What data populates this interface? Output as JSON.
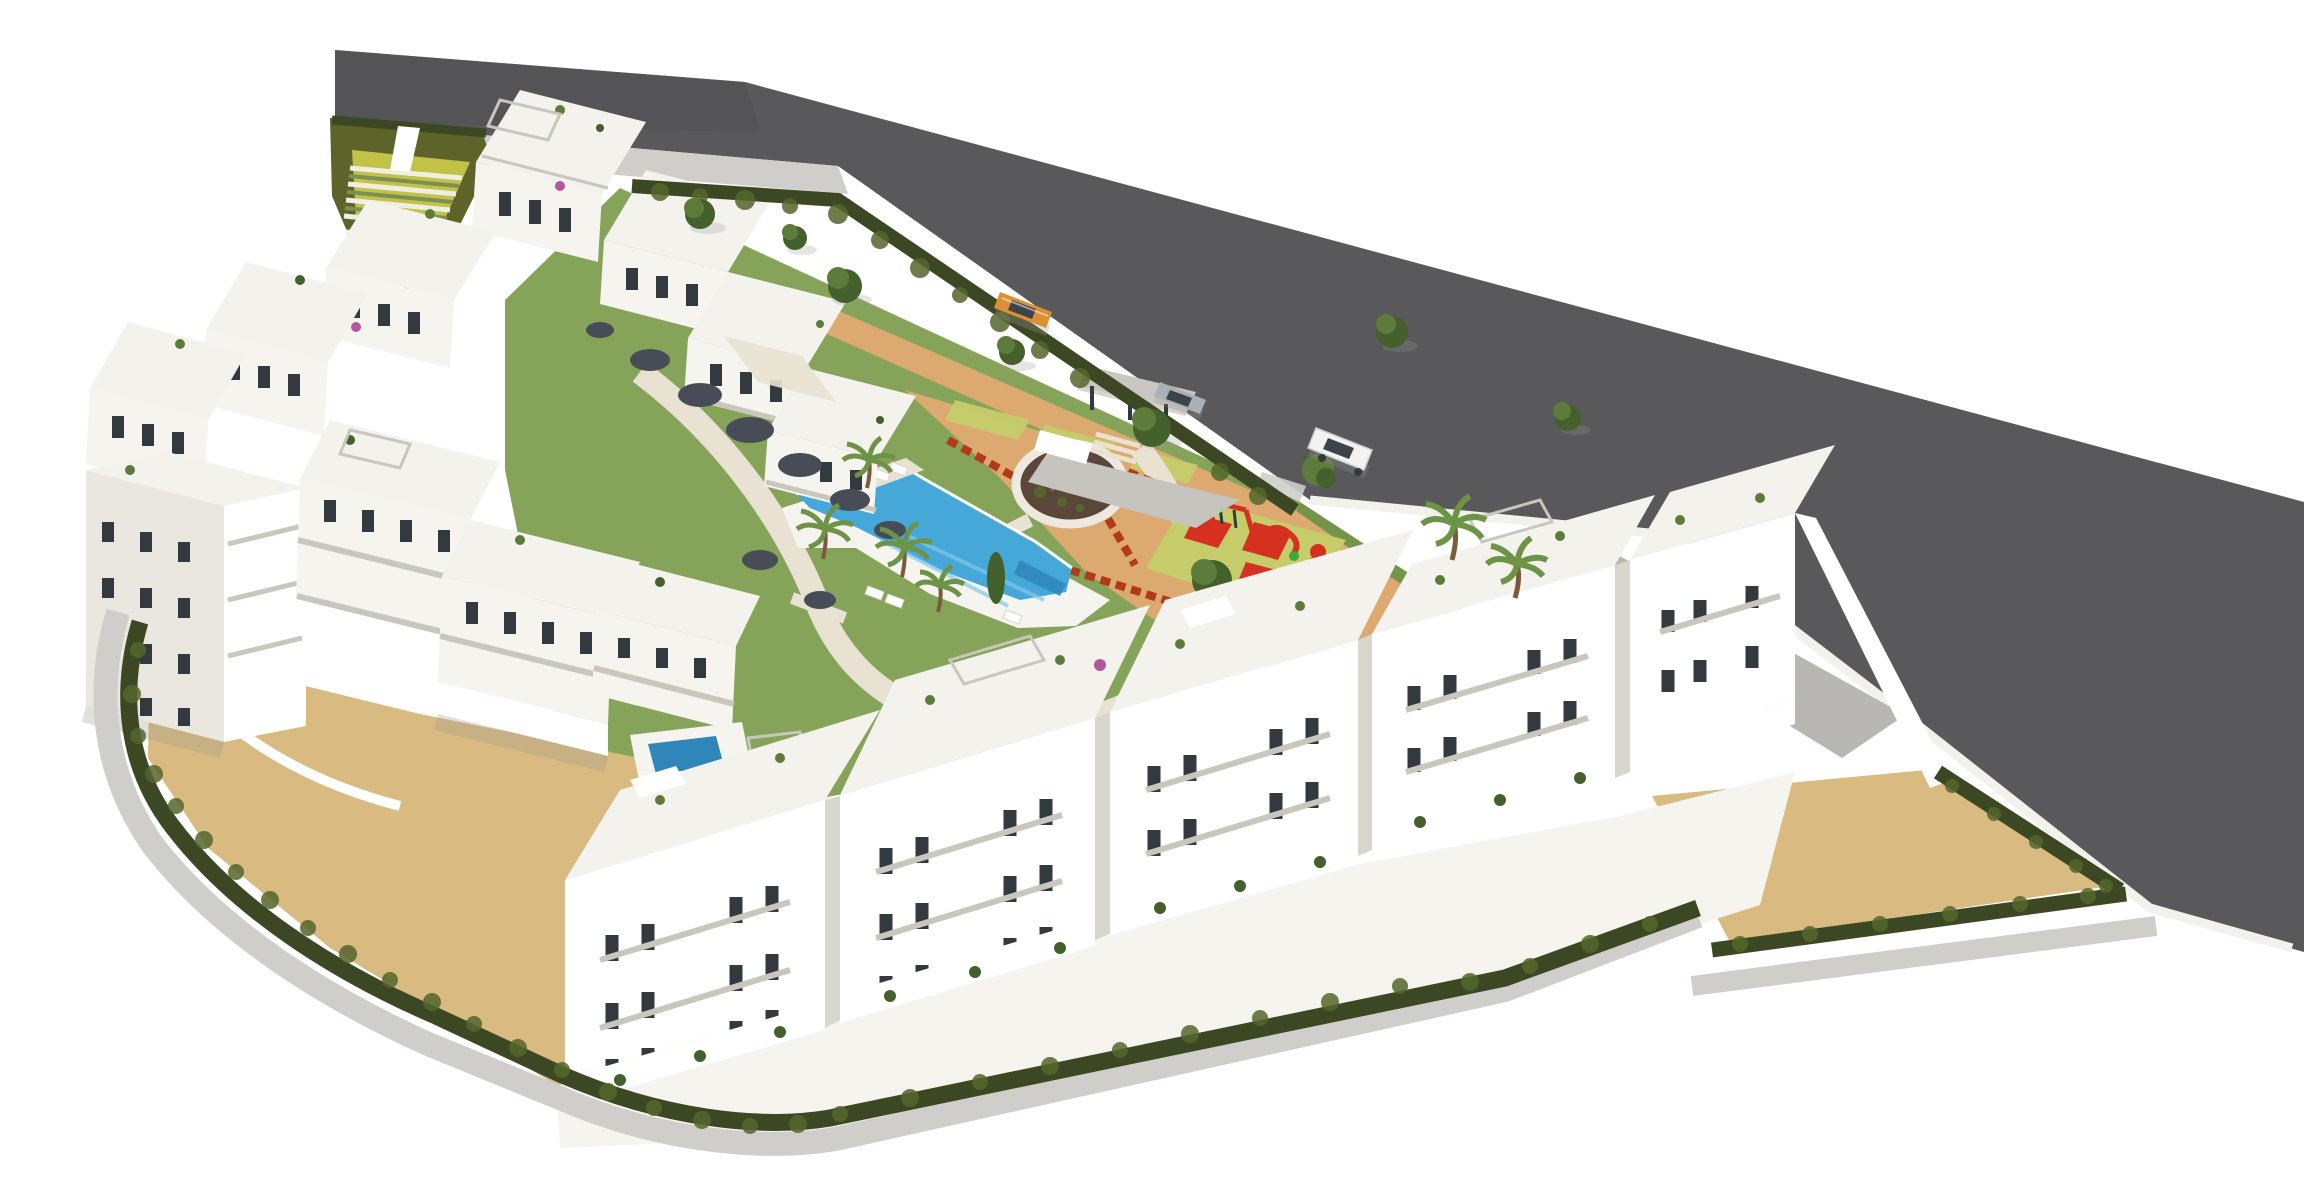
{
  "scene": {
    "type": "aerial-architectural-render",
    "subject": "white residential apartment complex with communal gardens",
    "features": [
      "perimeter-road",
      "amphitheatre-garden-steps",
      "terraced-apartment-cluster",
      "front-apartment-row",
      "communal-swimming-pool",
      "kids-pool",
      "sun-loungers",
      "circular-plaza-with-monument",
      "children-playground",
      "entrance-canopy",
      "perimeter-hedge",
      "sand-courtyards",
      "palm-trees",
      "street-trees"
    ],
    "vehicles": [
      {
        "name": "orange-car",
        "color": "#dd8f35"
      },
      {
        "name": "silver-car",
        "color": "#a9b0b6"
      },
      {
        "name": "white-suv",
        "color": "#f3f3f2"
      }
    ]
  },
  "colors": {
    "white": "#ffffff",
    "road": "#59585b",
    "roadEnd": "#4d4d50",
    "sidewalk": "#cfcecb",
    "curb": "#f2f1ec",
    "apron": "#b9b7b3",
    "hedge": "#3b4823",
    "hedge2": "#55662c",
    "olive": "#5e6429",
    "terraceYellow": "#c2c148",
    "stepWhite": "#efeee2",
    "stepGreen": "#7d9053",
    "lawn": "#85a45a",
    "lawn2": "#749549",
    "shrub": "#474c57",
    "sand": "#d9ba80",
    "terracotta": "#dcaa70",
    "path": "#e9e2d2",
    "paving": "#c6c4bf",
    "matYellow": "#c6cc6a",
    "playRed": "#d63020",
    "playGreen": "#3fa83b",
    "pool": "#45a8d9",
    "pool2": "#83c8ea",
    "pool3": "#2f86bb",
    "flower": "#b23a1a",
    "face": "#f6f4ef",
    "faceShade": "#e9e7df",
    "faceDeep": "#d9d6cd",
    "roof": "#f3f2ec",
    "window": "#333a3f",
    "frame": "#c9c6bd",
    "tree": "#5d7c3c",
    "treeDark": "#44602c",
    "palm": "#6d9346",
    "trunk": "#7a5b3a",
    "magenta": "#b5569a",
    "carOrange": "#dd8f35",
    "carSilver": "#a9b0b6",
    "carWhite": "#f3f3f2",
    "glass": "#3c4349",
    "canopy": "#c9c7c2",
    "mulch": "#5a4739",
    "stone": "#8a8579",
    "shadow": "#9b998f"
  }
}
